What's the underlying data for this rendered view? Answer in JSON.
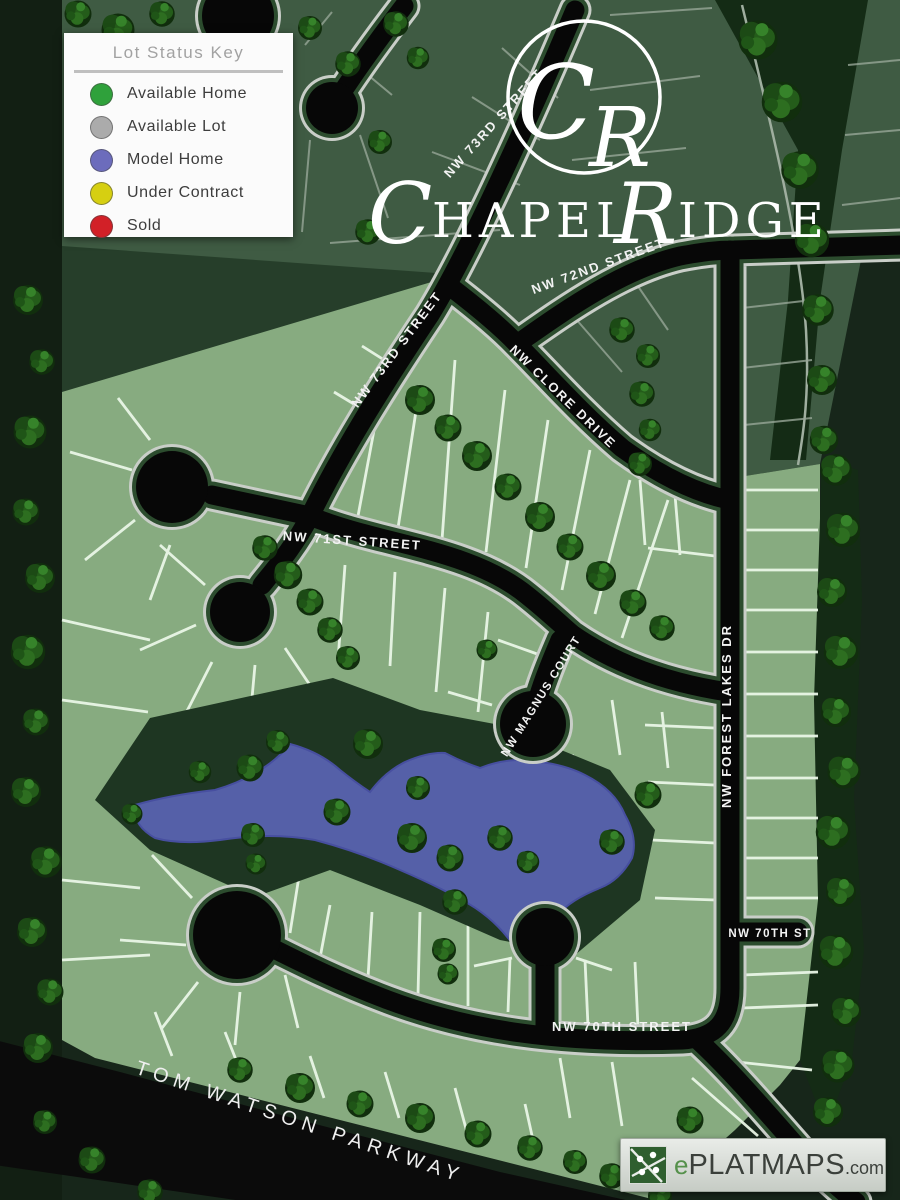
{
  "legend": {
    "title": "Lot Status Key",
    "items": [
      {
        "label": "Available Home",
        "color": "#2fa13b"
      },
      {
        "label": "Available Lot",
        "color": "#ababab"
      },
      {
        "label": "Model Home",
        "color": "#6c6cbc"
      },
      {
        "label": "Under Contract",
        "color": "#d6cf11"
      },
      {
        "label": "Sold",
        "color": "#d22027"
      }
    ]
  },
  "branding": {
    "monogram": {
      "c": "C",
      "r": "R"
    },
    "wordmark": {
      "initial1": "C",
      "word1": "HAPEL",
      "initial2": "R",
      "word2": "IDGE"
    }
  },
  "streets": {
    "nw_73rd_upper": "NW 73RD STREET",
    "nw_73rd_lower": "NW 73RD STREET",
    "nw_72nd": "NW 72ND STREET",
    "nw_clore": "NW CLORE DRIVE",
    "nw_71st": "NW 71ST STREET",
    "nw_magnus": "NW MAGNUS COURT",
    "nw_forest_lakes": "NW FOREST LAKES DR",
    "nw_70th_st": "NW 70TH ST",
    "nw_70th_street": "NW 70TH STREET",
    "tom_watson": "TOM WATSON PARKWAY"
  },
  "watermark": {
    "prefix": "e",
    "name": "PLATMAPS",
    "suffix": ".com"
  },
  "map_colors": {
    "pond": "#5560a8",
    "development_lot": "#87ab80",
    "existing_lot": "#3f5b43",
    "common_area": "#1e3622",
    "road": "#070707"
  }
}
